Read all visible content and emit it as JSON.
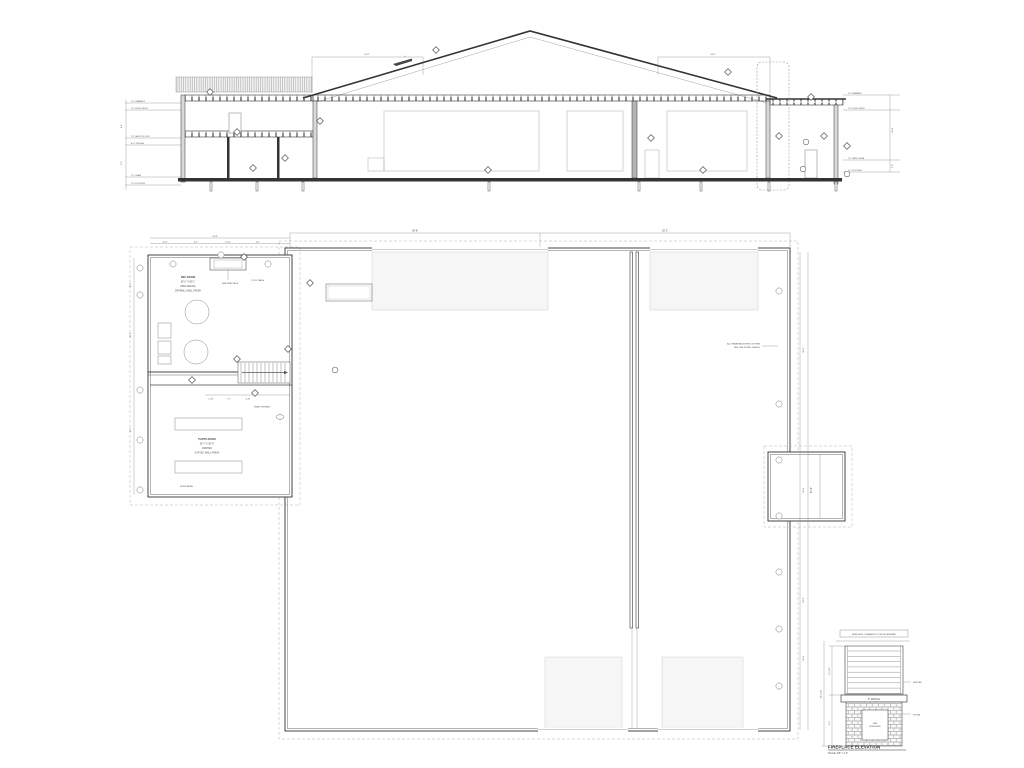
{
  "colors": {
    "line": "#333333",
    "light_line": "#8a8a8a",
    "faint": "#d8d8d8"
  },
  "section": {
    "datums_left": [
      "T.O. PARAPET",
      "T.O. ROOF DECK",
      "T.O. MEZZ. FLOOR",
      "B.O. CEILING",
      "T.O. SLAB",
      "T.O. FOOTING"
    ],
    "datums_right": [
      "T.O. PARAPET",
      "T.O. ROOF DECK",
      "T.O. PATIO SLAB",
      "T.O. FOOTING"
    ],
    "dim_left_roof": "14'-0\"",
    "dim_right_roof": "14'-0\"",
    "pitch": "4",
    "dim_left_side": [
      "6'-1\"",
      "9'-1\""
    ],
    "dim_right_side": [
      "10'-0\"",
      "4'-0\""
    ]
  },
  "plan": {
    "top_dim_left": "50'-8\"",
    "top_dim_right": "35'-2\"",
    "right_dims": [
      "16'-0\"",
      "16'-0\"",
      "16'-0\"",
      "16'-0\""
    ],
    "right_total": "80'-8\"",
    "wing_top_total": "28'-8\"",
    "wing_top_dims": [
      "10'-3\"",
      "4'-1\"",
      "6'-11\"",
      "4'-1\""
    ],
    "wing_left_dims": [
      "8'-0\"",
      "14'-1\"",
      "6'-1\""
    ],
    "rec_room": [
      "REC ROOM",
      "28'-2\" X 28'-1\"",
      "PINE CEILING",
      "DRYWALL WALL FINISH"
    ],
    "gas_fireplace": "GAS FIREPLACE",
    "pool_table": "POOL TABLE",
    "parts_room": [
      "PARTS ROOM",
      "26'-7\" X 28'-0\"",
      "PAINTED",
      "GYP. BD. WALL FINISH"
    ],
    "stair_opening": "STAIR OPENING",
    "stair_dims": [
      "2'-10\"",
      "7'-7\"",
      "3'-10\""
    ],
    "work_area": "WORK AREA",
    "rebar_note": [
      "ALL REBAR ANCHORED SYSTEM",
      "REF. SEE DETAIL 15/A-501"
    ]
  },
  "fireplace": {
    "clearance_note": "FIREPLACE CLEARANCE TO BE DETERMINED",
    "mantle": "8\" MANTLE",
    "shiplap": "SHIPLAP",
    "stone": "STONE",
    "firebox": [
      "GAS",
      "FIREPLACE"
    ],
    "title": "FIREPLACE ELEVATION",
    "scale": "SCALE: 3/8\" = 1'-0\"",
    "dims": {
      "upper": "6'-1 1/2\"",
      "lower": "4'-2\"",
      "total": "10'-1 1/2\""
    }
  },
  "glyphs": {
    "section_diamonds": [
      [
        436,
        50
      ],
      [
        728,
        72
      ],
      [
        210,
        92
      ],
      [
        320,
        121
      ],
      [
        237,
        132
      ],
      [
        285,
        158
      ],
      [
        253,
        168
      ],
      [
        488,
        170
      ],
      [
        651,
        138
      ],
      [
        703,
        170
      ],
      [
        811,
        97
      ],
      [
        779,
        136
      ],
      [
        824,
        136
      ],
      [
        847,
        146
      ]
    ],
    "section_circles": [
      [
        806,
        142
      ],
      [
        803,
        169
      ],
      [
        847,
        174
      ]
    ],
    "plan_diamonds": [
      [
        244,
        257
      ],
      [
        310,
        283
      ],
      [
        288,
        349
      ],
      [
        237,
        359
      ],
      [
        192,
        380
      ],
      [
        255,
        393
      ]
    ],
    "plan_circle_keynotes": [
      [
        335,
        370
      ]
    ],
    "plan_oval_keynotes": [
      [
        280,
        417
      ]
    ],
    "plan_bubbles_right": [
      [
        779,
        291
      ],
      [
        779,
        404
      ],
      [
        779,
        460
      ],
      [
        779,
        516
      ],
      [
        779,
        572
      ],
      [
        779,
        629
      ],
      [
        779,
        686
      ]
    ],
    "plan_bubbles_wing_top": [
      [
        173,
        264
      ],
      [
        221,
        255
      ],
      [
        268,
        264
      ]
    ],
    "plan_bubbles_wing_left": [
      [
        140,
        268
      ],
      [
        140,
        295
      ],
      [
        140,
        390
      ],
      [
        140,
        440
      ],
      [
        140,
        490
      ]
    ]
  }
}
